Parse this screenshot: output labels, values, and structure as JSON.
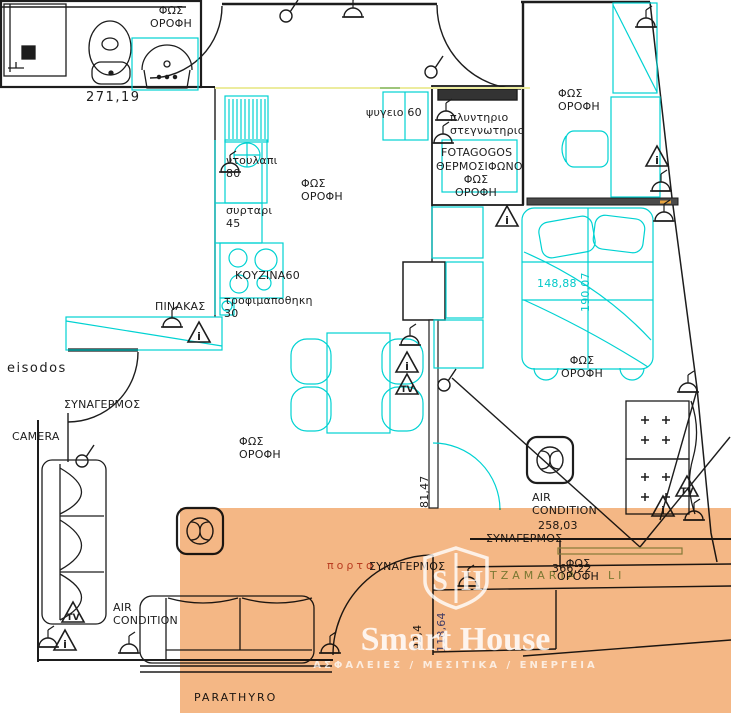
{
  "watermark": {
    "brand": "Smart House",
    "tagline": "ΑΣΦΑΛΕΙΕΣ  /  ΜΕΣΙΤΙΚΑ  /  ΕΝΕΡΓΕΙΑ",
    "logo_letter_left": "S",
    "logo_letter_right": "H",
    "overlay_color": "#ee8a3a"
  },
  "colors": {
    "furniture_cyan": "#00d2d2",
    "wall_black": "#1d1d1d",
    "dimension_blue": "#4553c0",
    "door_label_red": "#c2543d",
    "glass_green": "#7fa75f",
    "highlight_yellow": "#ecec9e"
  },
  "labels": {
    "fos_orofi_bath": "ΦΩΣ\nΟΡΟΦΗ",
    "psygeio": "ψυγειο 60",
    "plyntirio": "πλυντηριο\nστεγνωτηριο",
    "fotagogos": "FOTAGOGOS",
    "thermosifono": "ΘΕΡΜΟΣΙΦΩΝΟ",
    "fos_orofi_laundry": "ΦΩΣ\nΟΡΟΦΗ",
    "fos_orofi_top_right": "ΦΩΣ\nΟΡΟΦΗ",
    "ntoulapi": "ντουλαπι\n80",
    "fos_orofi_kitchen": "ΦΩΣ\nΟΡΟΦΗ",
    "syrtari": "συρταρι\n45",
    "kouzina": "ΚΟΥΖΙΝΑ60",
    "trofimapothiki": "τροφιμαποθηκη\n30",
    "pinakas": "ΠΙΝΑΚΑΣ",
    "eisodos": "eisodos",
    "synagermos_entrance": "ΣΥΝΑΓΕΡΜΟΣ",
    "camera": "CAMERA",
    "fos_orofi_living": "ΦΩΣ\nΟΡΟΦΗ",
    "fos_orofi_bedroom": "ΦΩΣ\nΟΡΟΦΗ",
    "air_condition_right": "AIR\nCONDITION",
    "synagermos_right": "ΣΥΝΑΓΕΡΜΟΣ",
    "porta": "πορτα",
    "synagermos_door": "ΣΥΝΑΓΕΡΜΟΣ",
    "tzamaria": "TZAMARIA",
    "tzamaria_fragment": "LI",
    "fos_orofi_glass": "ΦΩΣ\nΟΡΟΦΗ",
    "air_condition_left": "AIR\nCONDITION",
    "parathyro": "PARATHYRO"
  },
  "dimensions": {
    "bath_width": "271,19",
    "bed_width": "148,88",
    "bed_length": "190,07",
    "hall_wall": "81,47",
    "door_leaf": "92,4",
    "door_opening": "118,64",
    "balcony_width": "258,03",
    "glass_width": "366,22"
  },
  "icons": {
    "tv_label": "TV",
    "warning_glyph": "i"
  }
}
